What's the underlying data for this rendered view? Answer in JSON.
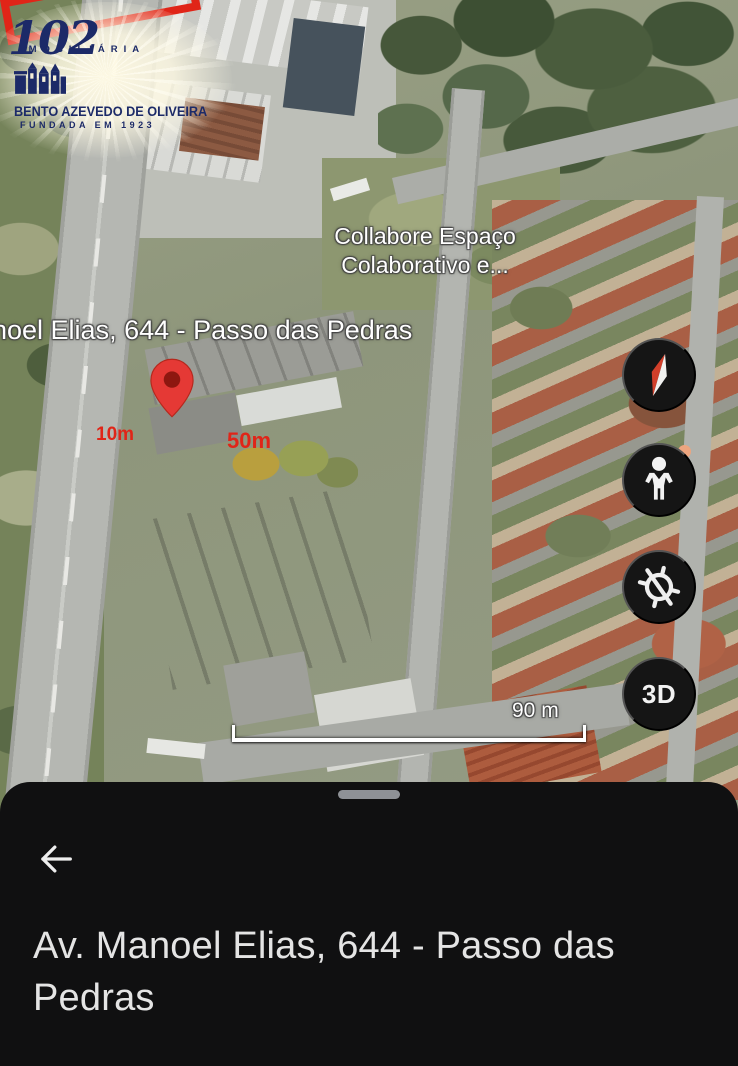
{
  "watermark": {
    "imobiliaria": "IMOBILIÁRIA",
    "anniversary": "102",
    "company": "BENTO AZEVEDO DE OLIVEIRA",
    "founded": "FUNDADA EM 1923",
    "text_color": "#1c2a68"
  },
  "map": {
    "poi_label": "Collabore Espaço Colaborativo e...",
    "street_label": "noel Elias, 644 - Passo das Pedras",
    "plot": {
      "width_label": "10m",
      "length_label": "50m",
      "outline_color": "#e02518"
    },
    "scale_label": "90 m",
    "controls": {
      "threed": "3D"
    },
    "marker_color": "#e53935"
  },
  "sheet": {
    "title": "Av. Manoel Elias, 644 - Passo das Pedras"
  }
}
